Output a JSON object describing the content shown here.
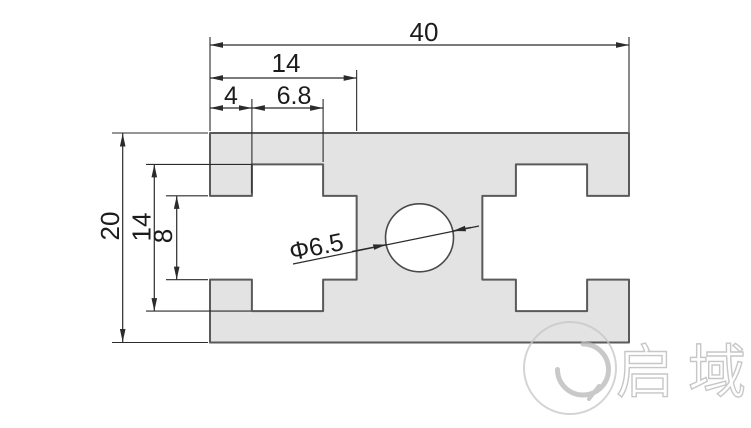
{
  "drawing": {
    "type": "engineering-section-drawing",
    "part": "2040-aluminium-profile-cross-section",
    "background": "#ffffff",
    "profile_fill": "#e3e3e3",
    "outline_color": "#5a5a5a",
    "dimension_color": "#2b2b2b",
    "watermark_color": "#b8b8b8"
  },
  "dimensions": {
    "total_width": "40",
    "slot_depth": "14",
    "slot_lip": "4",
    "slot_inner_width": "6.8",
    "total_height": "20",
    "slot_inner_height": "14",
    "slot_mouth_height": "8",
    "hole_diameter": "Φ6.5"
  },
  "watermark": {
    "brand": "启域"
  }
}
